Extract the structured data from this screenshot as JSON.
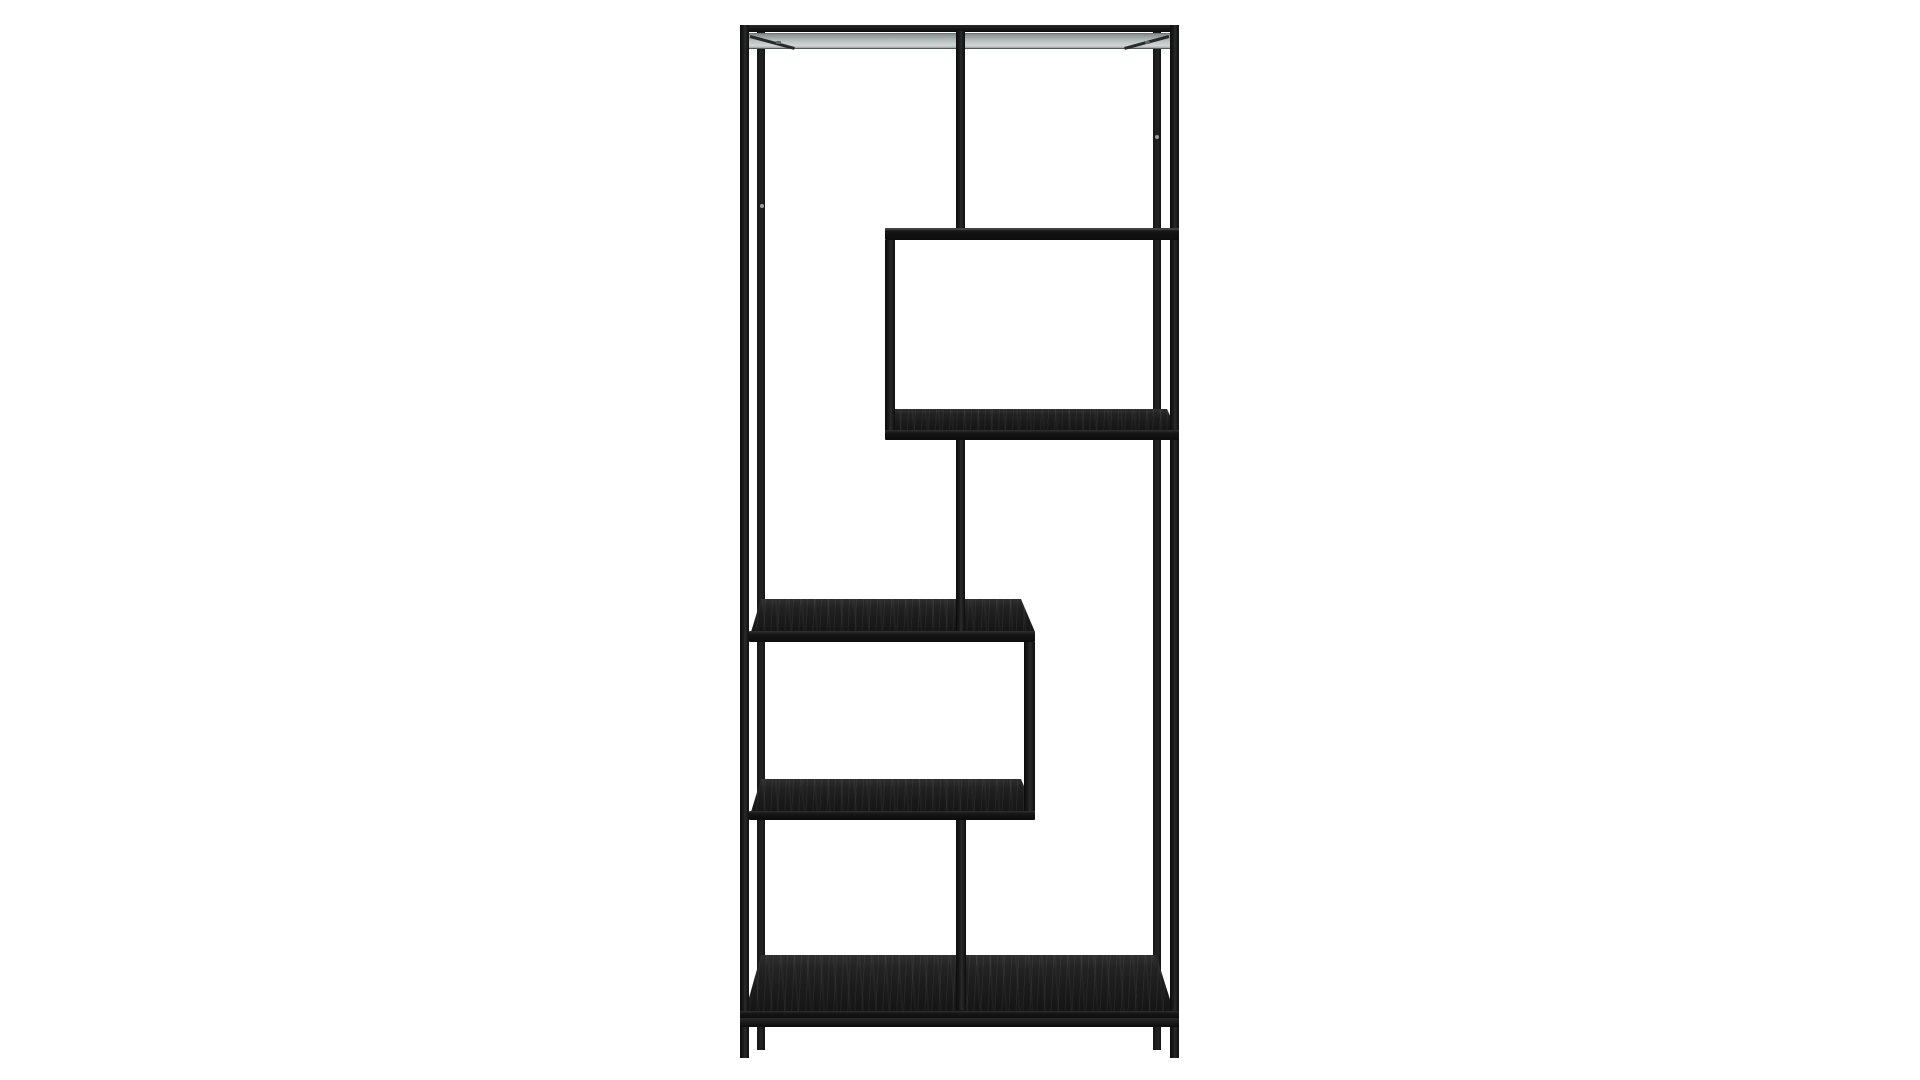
{
  "scene": {
    "description": "Product photograph of a tall black metal bookcase with asymmetric staggered shelves on a plain white background",
    "background_color": "#ffffff",
    "colors": {
      "frame": "#1a1a1a",
      "wood_surface": "#1b1b1b",
      "shelf_underside": "#b7bdbd",
      "screw": "#9aa0a0"
    },
    "structure": {
      "shelf_count": 6,
      "internal_vertical_supports": 5,
      "legs": 4,
      "layout": "zigzag: top shelf, right-side box, center dividers, left-side shelves, full-width bottom shelf"
    }
  }
}
